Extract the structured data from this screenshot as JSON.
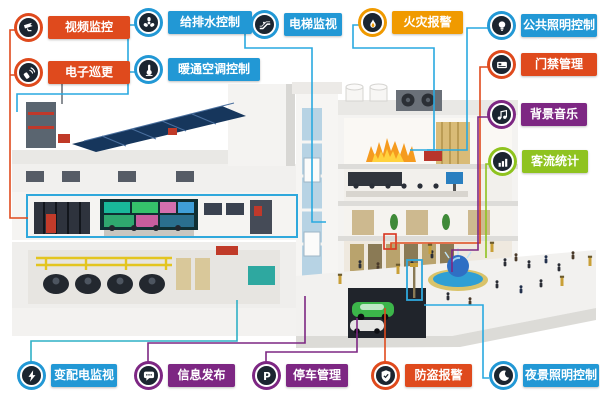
{
  "systems": [
    {
      "id": "video-surveillance",
      "label": "视频监控",
      "icon": "cctv-camera-icon",
      "color": "#DF4A1D"
    },
    {
      "id": "electronic-patrol",
      "label": "电子巡更",
      "icon": "patrol-scanner-icon",
      "color": "#DF4A1D"
    },
    {
      "id": "water-supply-drainage-control",
      "label": "给排水控制",
      "icon": "fan-impeller-icon",
      "color": "#2298D5"
    },
    {
      "id": "hvac-control",
      "label": "暖通空调控制",
      "icon": "thermostat-icon",
      "color": "#2298D5"
    },
    {
      "id": "elevator-monitoring",
      "label": "电梯监视",
      "icon": "escalator-icon",
      "color": "#2298D5"
    },
    {
      "id": "fire-alarm",
      "label": "火灾报警",
      "icon": "flame-icon",
      "color": "#F09A00"
    },
    {
      "id": "public-lighting-control",
      "label": "公共照明控制",
      "icon": "lightbulb-icon",
      "color": "#2298D5"
    },
    {
      "id": "access-control",
      "label": "门禁管理",
      "icon": "access-card-icon",
      "color": "#DF4A1D"
    },
    {
      "id": "background-music",
      "label": "背景音乐",
      "icon": "music-note-icon",
      "color": "#7D2783"
    },
    {
      "id": "passenger-flow-statistics",
      "label": "客流统计",
      "icon": "bar-chart-icon",
      "color": "#8FC31F"
    },
    {
      "id": "power-distribution-monitoring",
      "label": "变配电监视",
      "icon": "lightning-icon",
      "color": "#2298D5"
    },
    {
      "id": "information-release",
      "label": "信息发布",
      "icon": "speech-bubble-icon",
      "color": "#7D2783"
    },
    {
      "id": "parking-management",
      "label": "停车管理",
      "icon": "parking-p-icon",
      "color": "#7D2783"
    },
    {
      "id": "burglar-alarm",
      "label": "防盗报警",
      "icon": "shield-icon",
      "color": "#DF4A1D"
    },
    {
      "id": "night-lighting-control",
      "label": "夜景照明控制",
      "icon": "crescent-moon-icon",
      "color": "#2298D5"
    }
  ],
  "parking_letter": "P",
  "colors": {
    "label_red": "#DF4A1D",
    "label_blue": "#2298D5",
    "label_orange": "#F09A00",
    "label_purple": "#7D2783",
    "label_green": "#8FC31F",
    "badge_inner": "#1B2530",
    "line_blue": "#29A9E0",
    "line_red": "#DF4A1D",
    "line_purple": "#7D2783",
    "line_green": "#8FC31F",
    "line_cyan": "#2FB0C6",
    "highlight_box_blue": "#2FA8DC"
  },
  "annotations": [
    {
      "id": "control-room-highlight",
      "shape": "blue-rectangle"
    },
    {
      "id": "street-lamp-highlight",
      "shape": "blue-rectangle"
    },
    {
      "id": "entrance-door-highlight",
      "shape": "red-rectangle"
    }
  ]
}
